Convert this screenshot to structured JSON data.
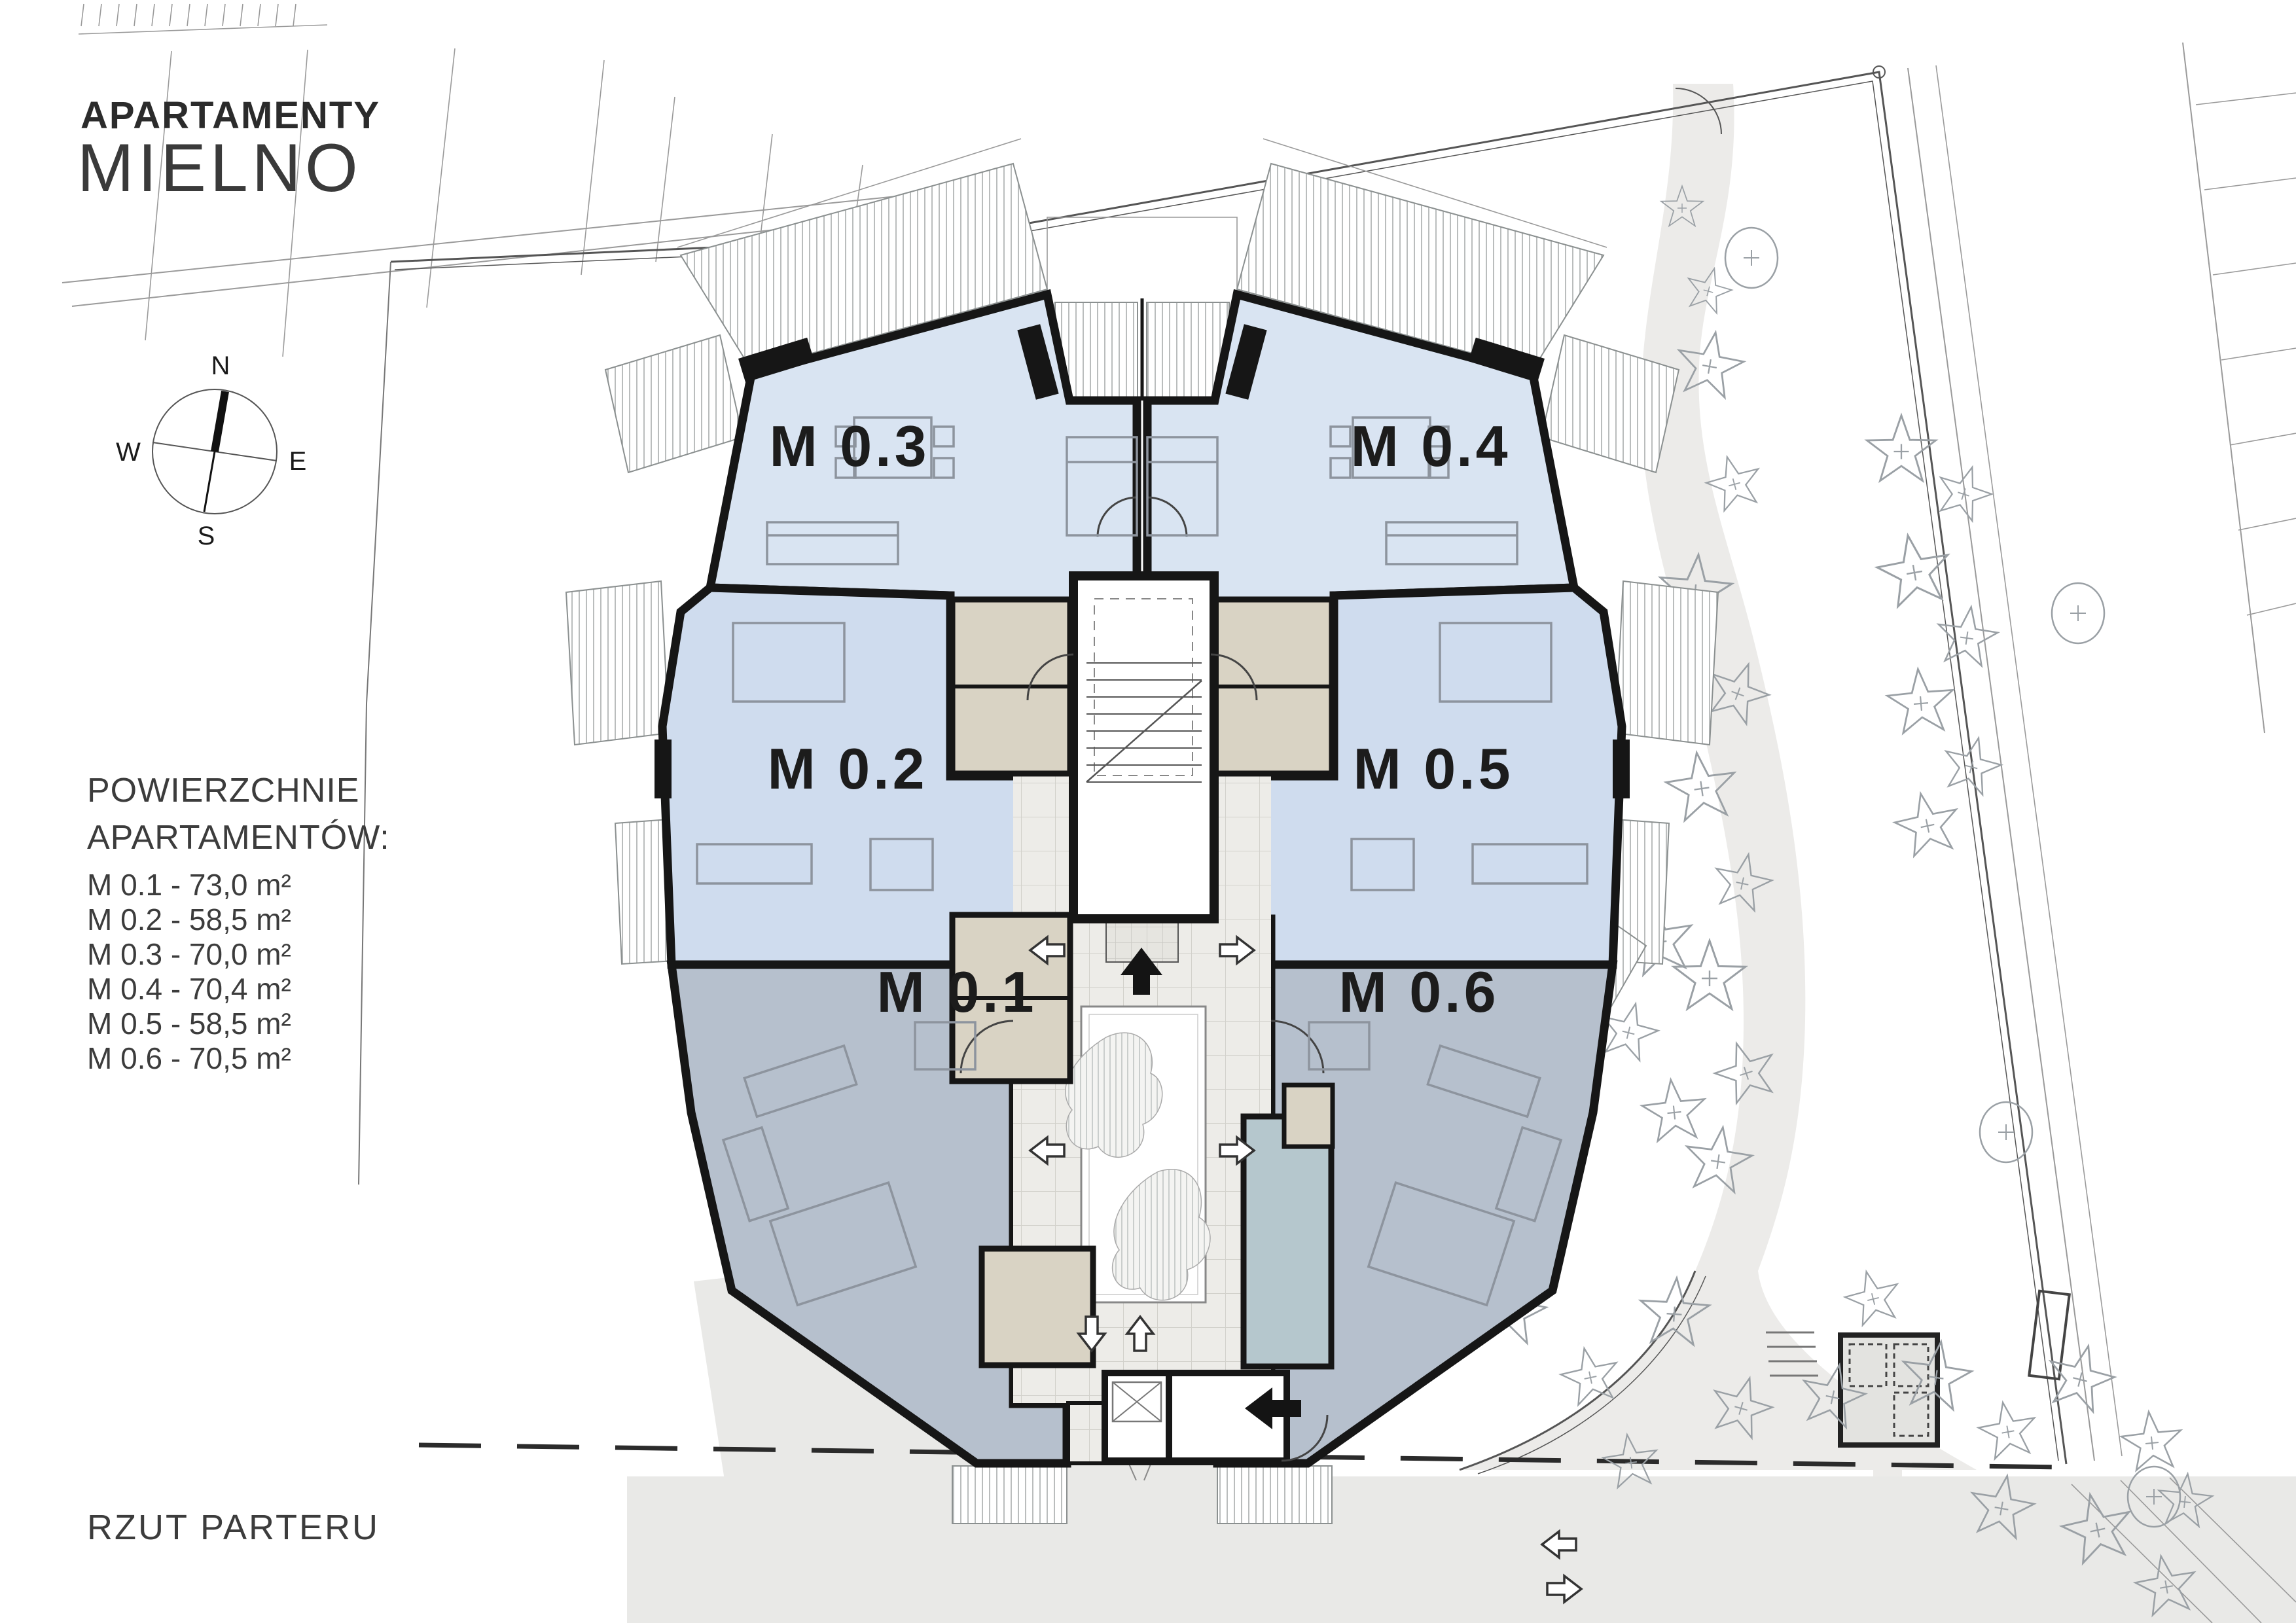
{
  "document": {
    "title_line1": "APARTAMENTY",
    "title_line2": "MIELNO",
    "plan_caption": "RZUT PARTERU"
  },
  "compass": {
    "north": "N",
    "south": "S",
    "east": "E",
    "west": "W"
  },
  "areas_list": {
    "heading_line1": "POWIERZCHNIE",
    "heading_line2": "APARTAMENTÓW:",
    "items": [
      {
        "label": "M 0.1 - 73,0 m²"
      },
      {
        "label": "M 0.2 - 58,5 m²"
      },
      {
        "label": "M 0.3 - 70,0 m²"
      },
      {
        "label": "M 0.4 - 70,4 m²"
      },
      {
        "label": "M 0.5 - 58,5 m²"
      },
      {
        "label": "M 0.6 - 70,5 m²"
      }
    ]
  },
  "apartments": [
    {
      "plan_label": "M 0.1",
      "area_m2": "73,0"
    },
    {
      "plan_label": "M 0.2",
      "area_m2": "58,5"
    },
    {
      "plan_label": "M 0.3",
      "area_m2": "70,0"
    },
    {
      "plan_label": "M 0.4",
      "area_m2": "70,4"
    },
    {
      "plan_label": "M 0.5",
      "area_m2": "58,5"
    },
    {
      "plan_label": "M 0.6",
      "area_m2": "70,5"
    }
  ],
  "colors": {
    "apartment_top_fill": "#d9e4f2",
    "apartment_mid_fill": "#cfdcee",
    "apartment_bottom_fill": "#b6c0cd",
    "bathroom_fill": "#d9d3c4",
    "laundry_fill": "#b5c7cd",
    "courtyard_tile": "#edece8",
    "road_fill": "#e9e9e7",
    "wall_color": "#161616"
  }
}
